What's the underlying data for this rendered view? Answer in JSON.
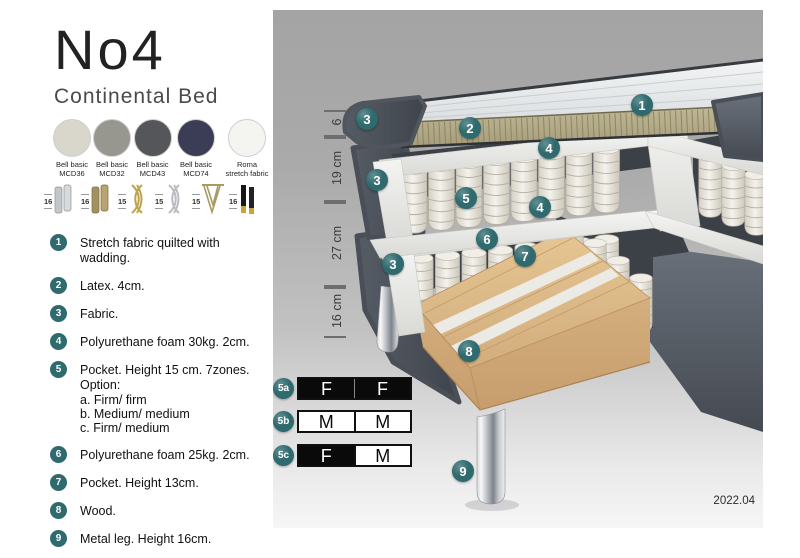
{
  "product": {
    "title": "No4",
    "subtitle": "Continental Bed"
  },
  "fabrics": [
    {
      "name": "Bell basic",
      "code": "MCD36",
      "color": "#d9d6cb",
      "weave": true
    },
    {
      "name": "Bell basic",
      "code": "MCD32",
      "color": "#97968f",
      "weave": true
    },
    {
      "name": "Bell basic",
      "code": "MCD43",
      "color": "#55565a",
      "weave": true
    },
    {
      "name": "Bell basic",
      "code": "MCD74",
      "color": "#3a3d55",
      "weave": true
    },
    {
      "name": "Roma",
      "code": "stretch fabric",
      "color": "#f4f4f1",
      "weave": false
    }
  ],
  "legs": [
    {
      "height": "16",
      "type": "cyl-silver"
    },
    {
      "height": "16",
      "type": "cyl-brass"
    },
    {
      "height": "15",
      "type": "twist-gold"
    },
    {
      "height": "15",
      "type": "twist-silver"
    },
    {
      "height": "15",
      "type": "hairpin"
    },
    {
      "height": "16",
      "type": "black-gold"
    }
  ],
  "features": [
    {
      "num": "1",
      "text": "Stretch fabric quilted with wadding.",
      "sub": []
    },
    {
      "num": "2",
      "text": "Latex. 4cm.",
      "sub": []
    },
    {
      "num": "3",
      "text": "Fabric.",
      "sub": []
    },
    {
      "num": "4",
      "text": "Polyurethane foam 30kg. 2cm.",
      "sub": []
    },
    {
      "num": "5",
      "text": "Pocket. Height 15 cm. 7zones. Option:",
      "sub": [
        "a. Firm/ firm",
        "b. Medium/ medium",
        "c. Firm/ medium"
      ]
    },
    {
      "num": "6",
      "text": "Polyurethane foam 25kg. 2cm.",
      "sub": []
    },
    {
      "num": "7",
      "text": "Pocket. Height 13cm.",
      "sub": []
    },
    {
      "num": "8",
      "text": "Wood.",
      "sub": []
    },
    {
      "num": "9",
      "text": "Metal leg. Height 16cm.",
      "sub": []
    }
  ],
  "diagram": {
    "accent": "#2e6a6e",
    "callouts": [
      {
        "label": "1",
        "x": 369,
        "y": 95
      },
      {
        "label": "2",
        "x": 197,
        "y": 118
      },
      {
        "label": "3",
        "x": 94,
        "y": 109
      },
      {
        "label": "4",
        "x": 276,
        "y": 138
      },
      {
        "label": "3",
        "x": 104,
        "y": 170
      },
      {
        "label": "5",
        "x": 193,
        "y": 188
      },
      {
        "label": "4",
        "x": 267,
        "y": 197
      },
      {
        "label": "6",
        "x": 214,
        "y": 229
      },
      {
        "label": "7",
        "x": 252,
        "y": 246
      },
      {
        "label": "3",
        "x": 120,
        "y": 254
      },
      {
        "label": "8",
        "x": 196,
        "y": 341
      },
      {
        "label": "9",
        "x": 190,
        "y": 461
      }
    ],
    "dimensions": [
      {
        "label": "6",
        "from": 100,
        "to": 125
      },
      {
        "label": "19 cm",
        "from": 127,
        "to": 190
      },
      {
        "label": "27 cm",
        "from": 192,
        "to": 275
      },
      {
        "label": "16 cm",
        "from": 277,
        "to": 326
      }
    ],
    "firmness": [
      {
        "id": "5a",
        "y": 367,
        "cells": [
          {
            "letter": "F",
            "fill": "black"
          },
          {
            "letter": "F",
            "fill": "black"
          }
        ]
      },
      {
        "id": "5b",
        "y": 400,
        "cells": [
          {
            "letter": "M",
            "fill": "white"
          },
          {
            "letter": "M",
            "fill": "white"
          }
        ]
      },
      {
        "id": "5c",
        "y": 434,
        "cells": [
          {
            "letter": "F",
            "fill": "black"
          },
          {
            "letter": "M",
            "fill": "white"
          }
        ]
      }
    ],
    "version": "2022.04"
  }
}
